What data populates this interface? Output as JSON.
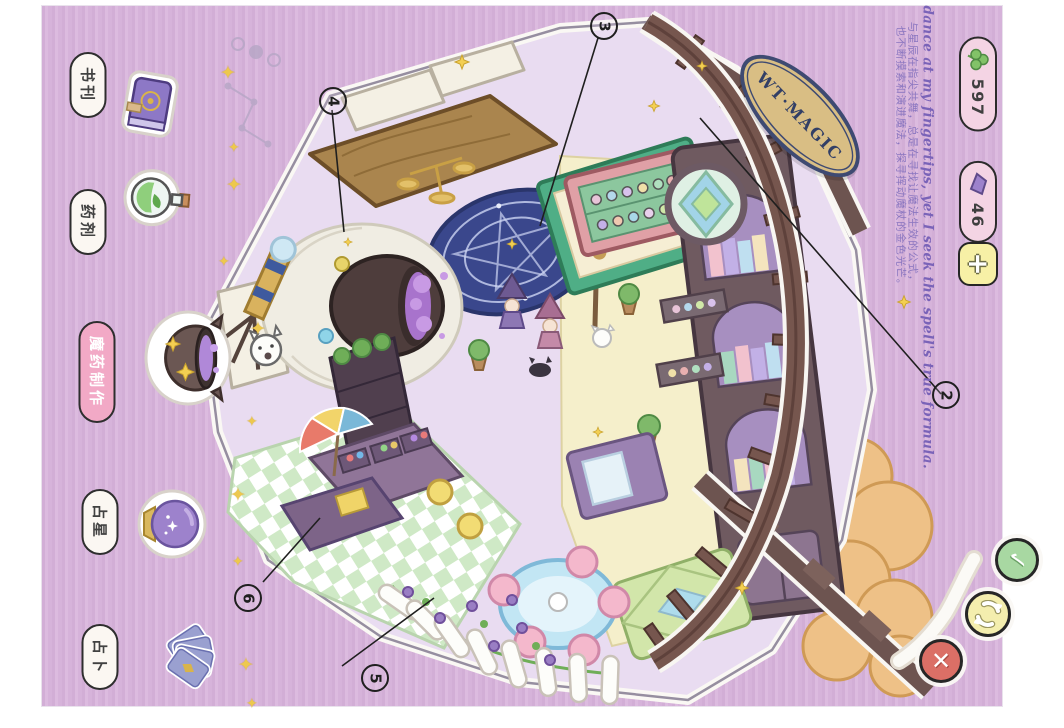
{
  "sign": {
    "text": "WT·MAGIC"
  },
  "sidebar": {
    "items": [
      {
        "label": "书刊",
        "icon": "book-icon",
        "selected": false
      },
      {
        "label": "药剂",
        "icon": "potion-bottle-icon",
        "selected": false
      },
      {
        "label": "魔药制作",
        "icon": "cauldron-icon",
        "selected": true
      },
      {
        "label": "占星",
        "icon": "crystal-ball-icon",
        "selected": false
      },
      {
        "label": "占卜",
        "icon": "tarot-cards-icon",
        "selected": false
      }
    ]
  },
  "hud": {
    "currencies": [
      {
        "icon": "clover-icon",
        "value": "597"
      },
      {
        "icon": "gem-icon",
        "value": "46"
      }
    ],
    "add_label": "+"
  },
  "caption": {
    "english": "Stars dance at my fingertips, yet I seek the spell's true formula.",
    "chinese_line1": "与星辰在指尖共舞，总是在寻找让魔法生效的公式，",
    "chinese_line2": "也不断摸索和演进魔法，探寻挥动魔杖的金色光芒。"
  },
  "callouts": [
    {
      "label": "2"
    },
    {
      "label": "3"
    },
    {
      "label": "4"
    },
    {
      "label": "5"
    },
    {
      "label": "6"
    }
  ],
  "colors": {
    "background": "#d8b7db",
    "currency_pill": "#f4d4e4",
    "selected_tab": "#f2a9c6",
    "close_red": "#db6f66",
    "rotate_yellow": "#f4eeae",
    "confirm_green": "#a8d8a2"
  }
}
